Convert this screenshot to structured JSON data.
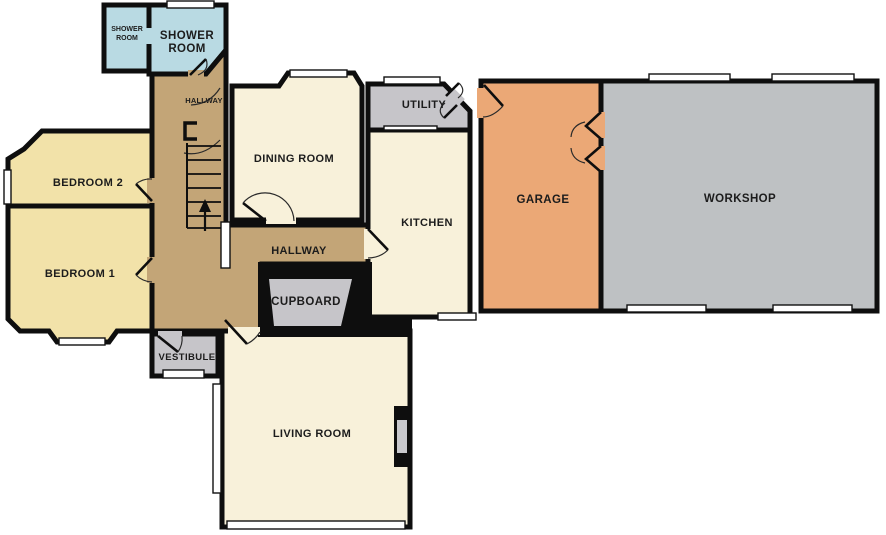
{
  "plan": {
    "title": "Ground floor plan",
    "rooms": {
      "shower_small": {
        "line1": "SHOWER",
        "line2": "ROOM"
      },
      "shower_large": {
        "line1": "SHOWER",
        "line2": "ROOM"
      },
      "hallway_upper": {
        "label": "HALLWAY"
      },
      "bedroom2": {
        "label": "BEDROOM 2"
      },
      "bedroom1": {
        "label": "BEDROOM 1"
      },
      "dining": {
        "label": "DINING ROOM"
      },
      "hallway": {
        "label": "HALLWAY"
      },
      "cupboard": {
        "label": "CUPBOARD"
      },
      "vestibule": {
        "label": "VESTIBULE"
      },
      "living": {
        "label": "LIVING ROOM"
      },
      "kitchen": {
        "label": "KITCHEN"
      },
      "utility": {
        "label": "UTILITY"
      },
      "garage": {
        "label": "GARAGE"
      },
      "workshop": {
        "label": "WORKSHOP"
      }
    },
    "colors": {
      "wall": "#0e0e0e",
      "shower": "#b9dae3",
      "hallway": "#c3a577",
      "bedroom": "#f2e2a9",
      "cream": "#f8f1da",
      "utility_gray": "#c6c5c9",
      "workshop_gray": "#bec1c3",
      "garage": "#eba876",
      "fireplace_inner": "#c9c9cd",
      "window": "#ffffff",
      "label_text": "#1c1c1c"
    }
  }
}
